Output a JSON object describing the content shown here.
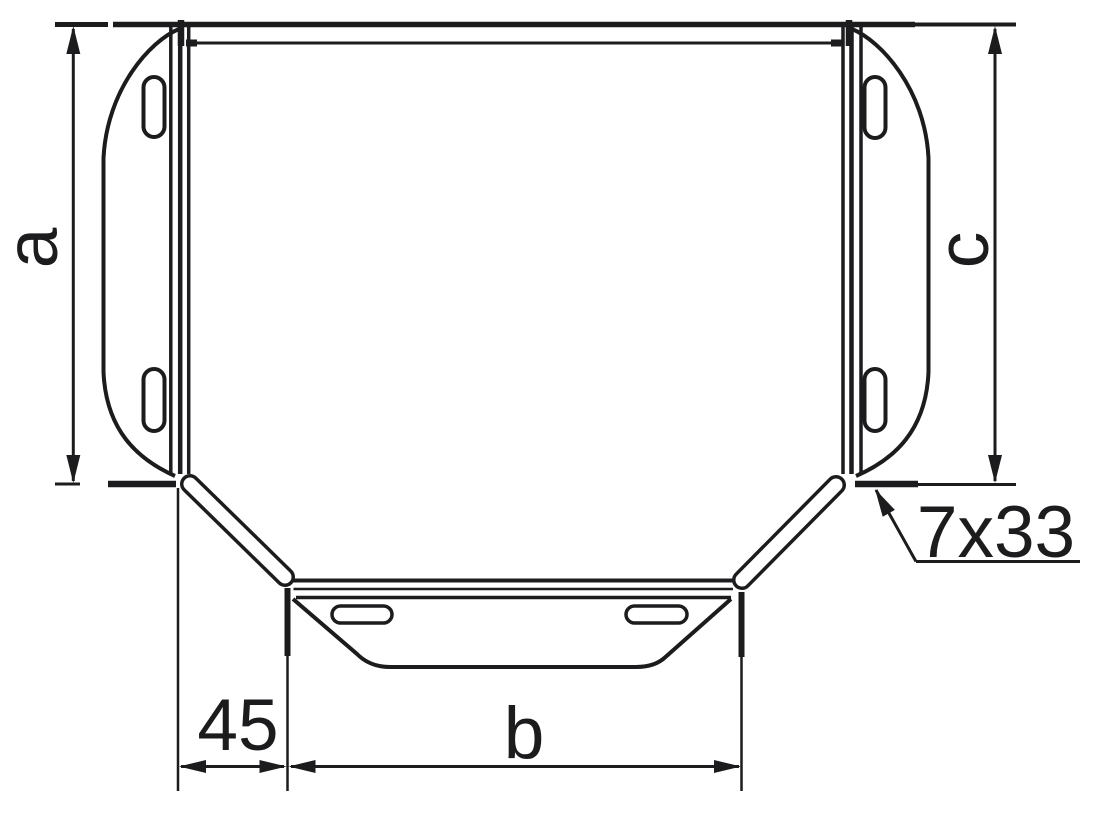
{
  "figure": {
    "background_color": "#ffffff",
    "line_color": "#1c1c1e",
    "labels": {
      "dim_left_height": "a",
      "dim_right_height": "c",
      "dim_branch_width": "b",
      "dim_offset": "45",
      "slot_callout": "7x33"
    }
  }
}
